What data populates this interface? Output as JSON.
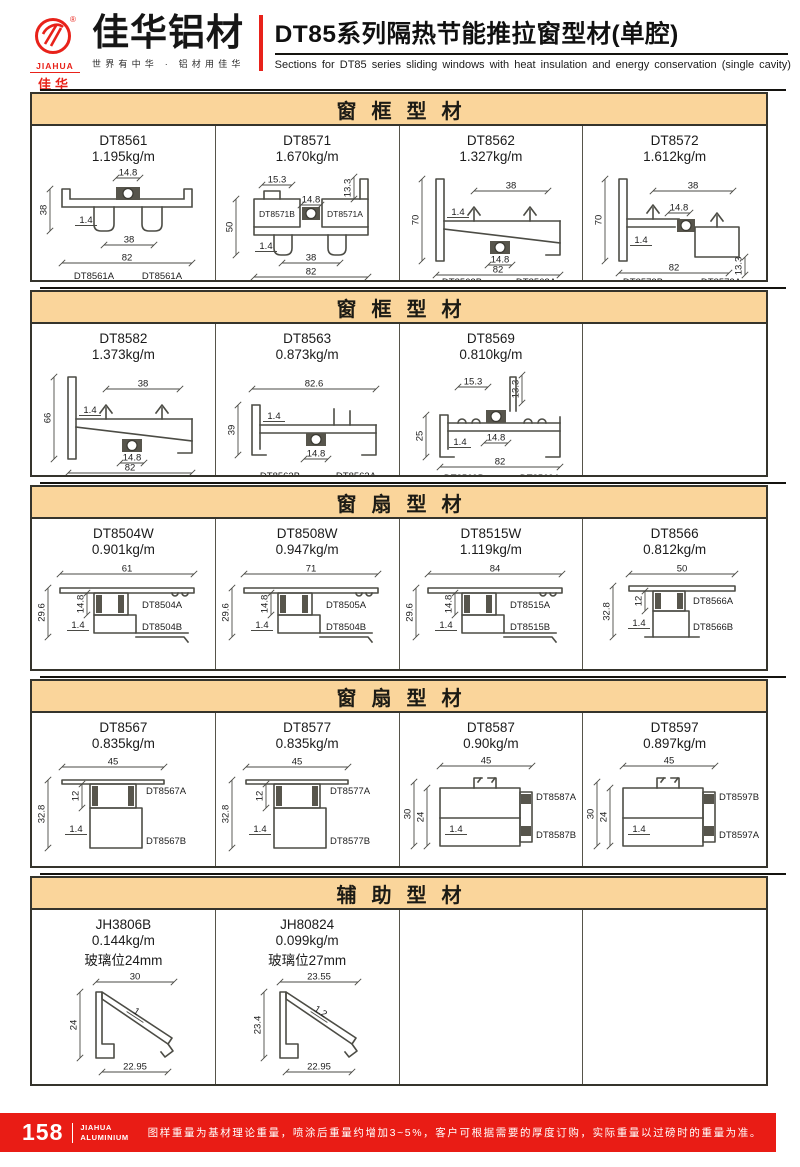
{
  "header": {
    "logo": {
      "brand_en": "JIAHUA",
      "brand_cn": "佳华",
      "reg_mark": "®"
    },
    "company": "佳华铝材",
    "tagline": "世界有中华 · 铝材用佳华",
    "title": "DT85系列隔热节能推拉窗型材(单腔)",
    "subtitle": "Sections for DT85 series sliding windows with heat insulation and energy conservation (single cavity)"
  },
  "colors": {
    "accent_red": "#e8221a",
    "section_band": "#fad59b",
    "table_border": "#35342c"
  },
  "sections": [
    {
      "title": "窗框型材",
      "items": [
        {
          "code": "DT8561",
          "weight": "1.195kg/m",
          "shape": "bottomRail",
          "labels": {
            "top": "14.8",
            "left": "38",
            "wall": "1.4",
            "mid": "38",
            "bottom": "82",
            "partL": "DT8561A",
            "partR": "DT8561A"
          }
        },
        {
          "code": "DT8571",
          "weight": "1.670kg/m",
          "shape": "stepRail",
          "labels": {
            "e1": "15.3",
            "e2": "13.3",
            "top": "14.8",
            "left": "50",
            "wall": "1.4",
            "mid": "38",
            "bottom": "82",
            "partL": "DT8571B",
            "partR": "DT8571A"
          }
        },
        {
          "code": "DT8562",
          "weight": "1.327kg/m",
          "shape": "jamb",
          "labels": {
            "top": "38",
            "left": "70",
            "wall": "1.4",
            "mid": "14.8",
            "bottom": "82",
            "partL": "DT8562B",
            "partR": "DT8562A"
          }
        },
        {
          "code": "DT8572",
          "weight": "1.612kg/m",
          "shape": "jambStep",
          "labels": {
            "top": "38",
            "left": "70",
            "wall": "1.4",
            "mid": "14.8",
            "bottom": "82",
            "e2": "13.3",
            "partL": "DT8572B",
            "partR": "DT8572A"
          }
        }
      ]
    },
    {
      "title": "窗框型材",
      "items": [
        {
          "code": "DT8582",
          "weight": "1.373kg/m",
          "shape": "jamb",
          "labels": {
            "top": "38",
            "left": "66",
            "wall": "1.4",
            "mid": "14.8",
            "bottom": "82",
            "partL": "DT8582B",
            "partR": "DT8582A"
          }
        },
        {
          "code": "DT8563",
          "weight": "0.873kg/m",
          "shape": "lowRail",
          "labels": {
            "top": "82.6",
            "left": "39",
            "wall": "1.4",
            "mid": "14.8",
            "partL": "DT8563B",
            "partR": "DT8563A"
          }
        },
        {
          "code": "DT8569",
          "weight": "0.810kg/m",
          "shape": "lowRail2",
          "labels": {
            "e1": "15.3",
            "e2": "13.3",
            "left": "25",
            "wall": "1.4",
            "mid": "14.8",
            "bottom": "82",
            "partL": "DT8569B",
            "partR": "DT8569A"
          }
        },
        null
      ]
    },
    {
      "title": "窗扇型材",
      "items": [
        {
          "code": "DT8504W",
          "weight": "0.901kg/m",
          "shape": "sashH",
          "labels": {
            "top": "61",
            "left": "29.6",
            "mid": "14.8",
            "wall": "1.4",
            "pA": "DT8504A",
            "pB": "DT8504B"
          }
        },
        {
          "code": "DT8508W",
          "weight": "0.947kg/m",
          "shape": "sashH",
          "labels": {
            "top": "71",
            "left": "29.6",
            "mid": "14.8",
            "wall": "1.4",
            "pA": "DT8505A",
            "pB": "DT8504B"
          }
        },
        {
          "code": "DT8515W",
          "weight": "1.119kg/m",
          "shape": "sashH",
          "labels": {
            "top": "84",
            "left": "29.6",
            "mid": "14.8",
            "wall": "1.4",
            "pA": "DT8515A",
            "pB": "DT8515B"
          }
        },
        {
          "code": "DT8566",
          "weight": "0.812kg/m",
          "shape": "sashH2",
          "labels": {
            "top": "50",
            "left": "32.8",
            "mid": "12",
            "wall": "1.4",
            "pA": "DT8566A",
            "pB": "DT8566B"
          }
        }
      ]
    },
    {
      "title": "窗扇型材",
      "items": [
        {
          "code": "DT8567",
          "weight": "0.835kg/m",
          "shape": "sashV",
          "labels": {
            "top": "45",
            "left": "32.8",
            "mid": "12",
            "wall": "1.4",
            "pA": "DT8567A",
            "pB": "DT8567B"
          }
        },
        {
          "code": "DT8577",
          "weight": "0.835kg/m",
          "shape": "sashV",
          "labels": {
            "top": "45",
            "left": "32.8",
            "mid": "12",
            "wall": "1.4",
            "pA": "DT8577A",
            "pB": "DT8577B"
          }
        },
        {
          "code": "DT8587",
          "weight": "0.90kg/m",
          "shape": "sashV2",
          "labels": {
            "top": "45",
            "left": "30",
            "left2": "24",
            "wall": "1.4",
            "pA": "DT8587A",
            "pB": "DT8587B"
          }
        },
        {
          "code": "DT8597",
          "weight": "0.897kg/m",
          "shape": "sashV2",
          "labels": {
            "top": "45",
            "left": "30",
            "left2": "24",
            "wall": "1.4",
            "pA": "DT8597B",
            "pB": "DT8597A"
          }
        }
      ]
    },
    {
      "title": "辅助型材",
      "items": [
        {
          "code": "JH3806B",
          "weight": "0.144kg/m",
          "note": "玻璃位24mm",
          "shape": "bead",
          "labels": {
            "top": "30",
            "left": "24",
            "wall": "1",
            "bottom": "22.95"
          }
        },
        {
          "code": "JH80824",
          "weight": "0.099kg/m",
          "note": "玻璃位27mm",
          "shape": "bead",
          "labels": {
            "top": "23.55",
            "left": "23.4",
            "wall": "1.2",
            "bottom": "22.95"
          }
        },
        null,
        null
      ]
    }
  ],
  "footer": {
    "page_number": "158",
    "brand_line1": "JIAHUA",
    "brand_line2": "ALUMINIUM",
    "note": "图样重量为基材理论重量，喷涂后重量约增加3~5%，客户可根据需要的厚度订购，实际重量以过磅时的重量为准。"
  }
}
